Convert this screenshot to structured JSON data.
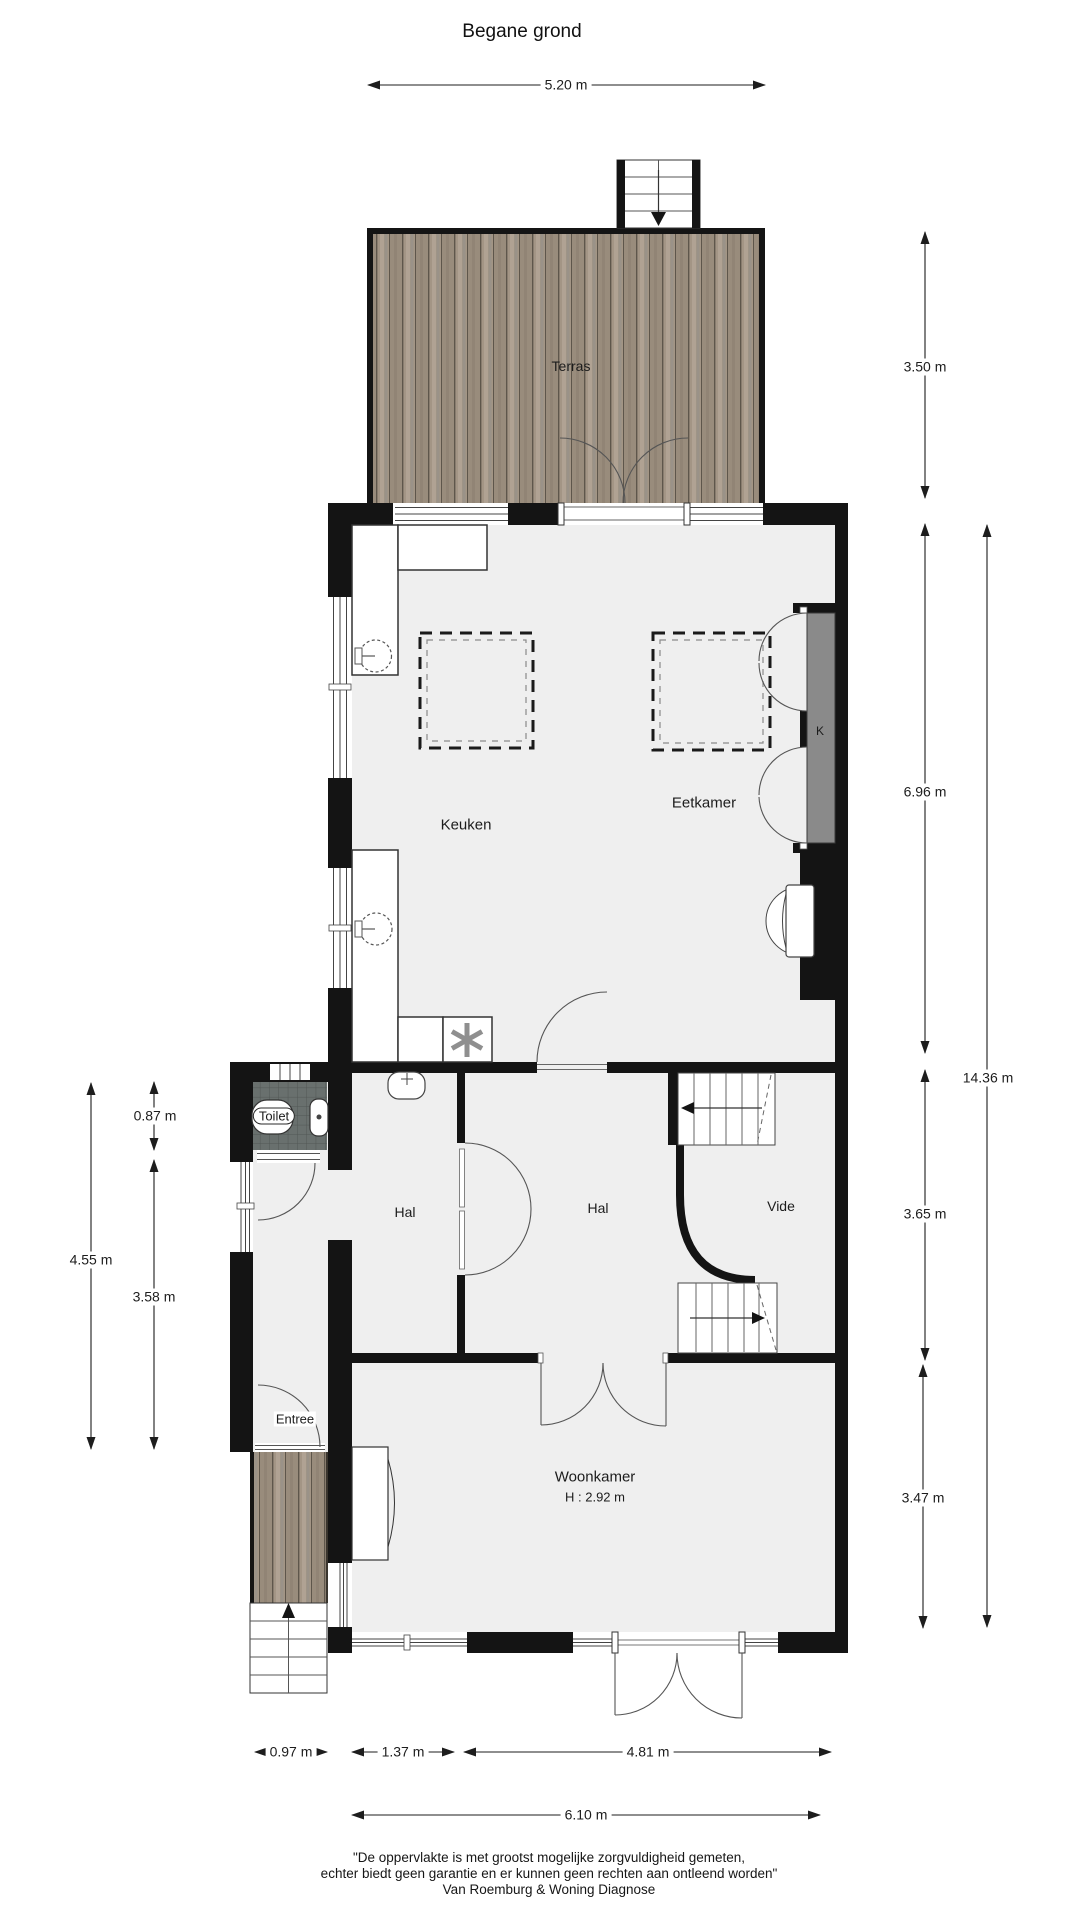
{
  "title": "Begane grond",
  "rooms": {
    "terras": "Terras",
    "keuken": "Keuken",
    "eetkamer": "Eetkamer",
    "kast": "K",
    "toilet": "Toilet",
    "hal_voor": "Hal",
    "hal_midden": "Hal",
    "vide": "Vide",
    "entree": "Entree",
    "woonkamer": "Woonkamer",
    "woonkamer_hoogte": "H : 2.92 m"
  },
  "dimensions": {
    "terras_breedte": "5.20 m",
    "terras_diepte": "3.50 m",
    "keuken_eetkamer_diepte": "6.96 m",
    "totaal_diepte": "14.36 m",
    "hal_diepte": "3.65 m",
    "woonkamer_diepte": "3.47 m",
    "toilet_diepte": "0.87 m",
    "entree_totaal_diepte": "4.55 m",
    "entree_diepte": "3.58 m",
    "veranda_breedte": "0.97 m",
    "hal_breedte": "1.37 m",
    "woonkamer_breedte": "4.81 m",
    "totaal_breedte": "6.10 m"
  },
  "footer": {
    "line1": "\"De oppervlakte is met grootst mogelijke zorgvuldigheid gemeten,",
    "line2": "echter biedt geen garantie en er kunnen geen rechten aan ontleend worden\"",
    "line3": "Van Roemburg & Woning Diagnose"
  },
  "colors": {
    "wall": "#141414",
    "floor": "#efefef",
    "tile": "#69706e",
    "wood_light": "#a39585",
    "wood_dark": "#5e564b",
    "closet": "#8a8a8a",
    "dimension": "#222222"
  }
}
